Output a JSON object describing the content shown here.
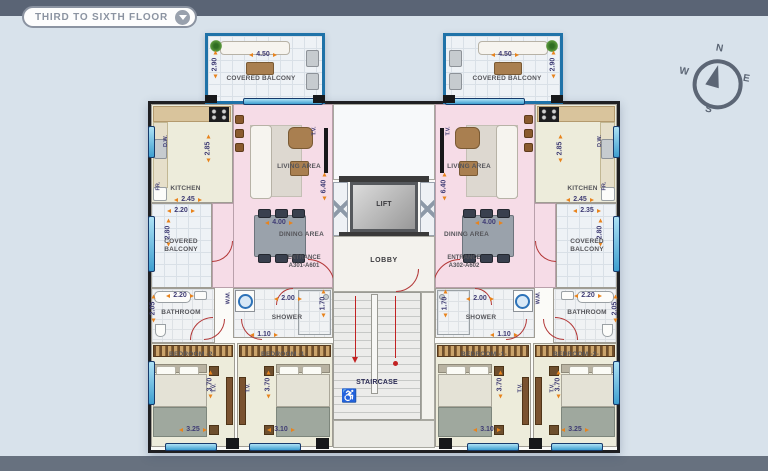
{
  "header": {
    "title": "THIRD TO SIXTH FLOOR"
  },
  "compass": {
    "north": "N",
    "east": "E",
    "south": "S",
    "west": "W"
  },
  "core": {
    "lift_label": "LIFT",
    "lobby_label": "LOBBY",
    "staircase_label": "STAIRCASE"
  },
  "apartments": {
    "left": {
      "entrance_line1": "ENTRANCE",
      "entrance_line2": "A301-A601",
      "top_balcony": {
        "label": "COVERED BALCONY",
        "w": "4.50",
        "h": "2.90"
      },
      "kitchen": {
        "label": "KITCHEN",
        "w": "2.45",
        "h": "2.85",
        "dw": "D.W.",
        "fr": "FR."
      },
      "living": {
        "label": "LIVING AREA",
        "h": "6.40",
        "tv": "T.V."
      },
      "dining": {
        "label": "DINING AREA",
        "w": "4.00"
      },
      "side_balcony": {
        "label": "COVERED BALCONY",
        "w": "2.20",
        "h": "2.80"
      },
      "bathroom": {
        "label": "BATHROOM",
        "w": "2.20",
        "h": "2.05"
      },
      "shower": {
        "label": "SHOWER",
        "w": "2.00",
        "h": "1.70",
        "wm": "W.M.",
        "corridor_w": "1.10"
      },
      "bedroom1": {
        "label": "BEDROOM -1-",
        "w": "3.10",
        "h": "3.70",
        "tv": "T.V."
      },
      "bedroom2": {
        "label": "BEDROOM -2-",
        "w": "3.25",
        "h": "3.70",
        "tv": "T.V."
      }
    },
    "right": {
      "entrance_line1": "ENTRANCE",
      "entrance_line2": "A302-A602",
      "top_balcony": {
        "label": "COVERED BALCONY",
        "w": "4.50",
        "h": "2.90"
      },
      "kitchen": {
        "label": "KITCHEN",
        "w": "2.45",
        "h": "2.85",
        "dw": "D.W.",
        "fr": "FR."
      },
      "living": {
        "label": "LIVING AREA",
        "h": "6.40",
        "tv": "T.V."
      },
      "dining": {
        "label": "DINING AREA",
        "w": "4.00"
      },
      "side_balcony": {
        "label": "COVERED BALCONY",
        "w": "2.35",
        "h": "2.80"
      },
      "bathroom": {
        "label": "BATHROOM",
        "w": "2.20",
        "h": "2.05"
      },
      "shower": {
        "label": "SHOWER",
        "w": "2.00",
        "h": "1.70",
        "wm": "W.M.",
        "corridor_w": "1.10"
      },
      "bedroom1": {
        "label": "BEDROOM -1-",
        "w": "3.10",
        "h": "3.70",
        "tv": "T.V."
      },
      "bedroom2": {
        "label": "BEDROOM -2-",
        "w": "3.25",
        "h": "3.70",
        "tv": "T.V."
      }
    }
  }
}
